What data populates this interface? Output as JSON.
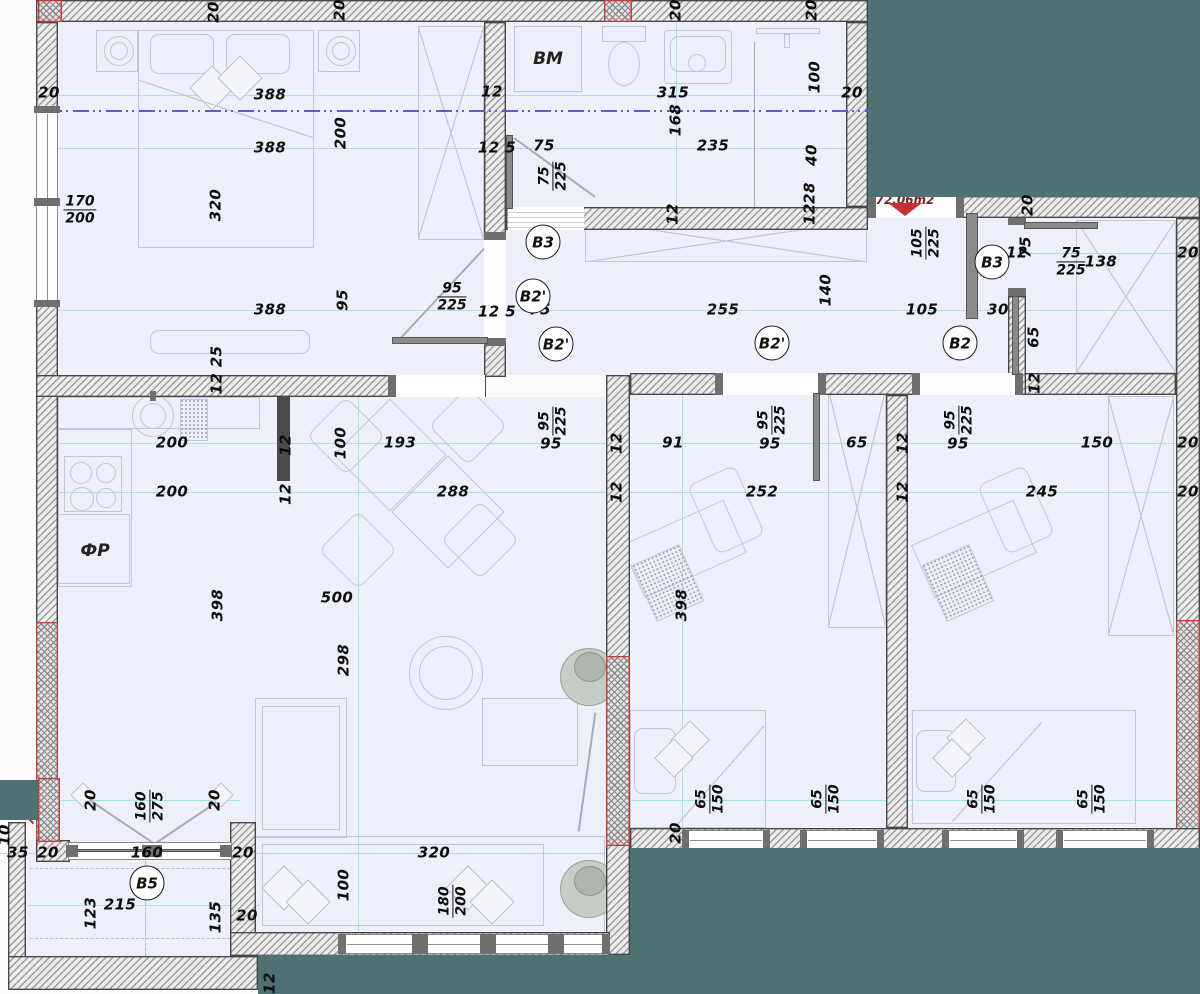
{
  "title": "Apartment floor plan 72.06m2",
  "colors": {
    "outside": "#4e7174",
    "room_fill": "#edeffa",
    "wall_hatch": "#9c9c9c",
    "accent_red": "#c53030",
    "dim_text": "#0d0d0d",
    "dim_line_cyan": "#a6e3e6",
    "axis_blue": "#5b5bd6"
  },
  "area": {
    "text": "72.06m2"
  },
  "room_labels": [
    {
      "text": "BM",
      "x": 548,
      "y": 59
    },
    {
      "text": "ФР",
      "x": 95,
      "y": 551
    }
  ],
  "circles": [
    {
      "label": "B3",
      "x": 543,
      "y": 242
    },
    {
      "label": "B2'",
      "x": 533,
      "y": 296
    },
    {
      "label": "B2'",
      "x": 556,
      "y": 344
    },
    {
      "label": "B2'",
      "x": 772,
      "y": 343
    },
    {
      "label": "B2",
      "x": 960,
      "y": 343
    },
    {
      "label": "B3",
      "x": 992,
      "y": 262
    },
    {
      "label": "B5",
      "x": 147,
      "y": 883
    }
  ],
  "dims": [
    {
      "t": "20",
      "x": 214,
      "y": 12,
      "r": 1
    },
    {
      "t": "20",
      "x": 340,
      "y": 10,
      "r": 1
    },
    {
      "t": "20",
      "x": 676,
      "y": 10,
      "r": 1
    },
    {
      "t": "20",
      "x": 812,
      "y": 10,
      "r": 1
    },
    {
      "t": "20",
      "x": 49,
      "y": 93
    },
    {
      "t": "388",
      "x": 270,
      "y": 95
    },
    {
      "t": "12",
      "x": 492,
      "y": 92
    },
    {
      "t": "315",
      "x": 673,
      "y": 93
    },
    {
      "t": "100",
      "x": 815,
      "y": 77,
      "r": 1
    },
    {
      "t": "20",
      "x": 852,
      "y": 93
    },
    {
      "t": "388",
      "x": 270,
      "y": 148
    },
    {
      "t": "200",
      "x": 341,
      "y": 133,
      "r": 1
    },
    {
      "t": "12 5",
      "x": 497,
      "y": 148
    },
    {
      "t": "75",
      "x": 544,
      "y": 146
    },
    {
      "t": "235",
      "x": 713,
      "y": 146
    },
    {
      "t": "168",
      "x": 676,
      "y": 120,
      "r": 1
    },
    {
      "t": "40",
      "x": 812,
      "y": 155,
      "r": 1
    },
    {
      "t": "28",
      "x": 810,
      "y": 193,
      "r": 1
    },
    {
      "t": "12",
      "x": 810,
      "y": 214,
      "r": 1
    },
    {
      "t": "320",
      "x": 216,
      "y": 205,
      "r": 1
    },
    {
      "t": "12",
      "x": 673,
      "y": 214,
      "r": 1
    },
    {
      "t": "20",
      "x": 1028,
      "y": 205,
      "r": 1
    },
    {
      "t": "12",
      "x": 1017,
      "y": 253
    },
    {
      "t": "75",
      "x": 1026,
      "y": 247,
      "r": 1
    },
    {
      "t": "138",
      "x": 1101,
      "y": 262
    },
    {
      "t": "20",
      "x": 1188,
      "y": 253
    },
    {
      "t": "388",
      "x": 270,
      "y": 310
    },
    {
      "t": "95",
      "x": 343,
      "y": 300,
      "r": 1
    },
    {
      "t": "12 5",
      "x": 497,
      "y": 312
    },
    {
      "t": "75",
      "x": 540,
      "y": 310
    },
    {
      "t": "140",
      "x": 826,
      "y": 290,
      "r": 1
    },
    {
      "t": "255",
      "x": 723,
      "y": 310
    },
    {
      "t": "105",
      "x": 922,
      "y": 310
    },
    {
      "t": "30",
      "x": 998,
      "y": 310
    },
    {
      "t": "65",
      "x": 1034,
      "y": 337,
      "r": 1
    },
    {
      "t": "12 25",
      "x": 217,
      "y": 370,
      "r": 1
    },
    {
      "t": "12",
      "x": 1035,
      "y": 383,
      "r": 1
    },
    {
      "t": "200",
      "x": 172,
      "y": 443
    },
    {
      "t": "12",
      "x": 286,
      "y": 445,
      "r": 1
    },
    {
      "t": "100",
      "x": 341,
      "y": 443,
      "r": 1
    },
    {
      "t": "193",
      "x": 400,
      "y": 443
    },
    {
      "t": "95",
      "x": 551,
      "y": 444
    },
    {
      "t": "12",
      "x": 617,
      "y": 443,
      "r": 1
    },
    {
      "t": "91",
      "x": 673,
      "y": 443
    },
    {
      "t": "95",
      "x": 770,
      "y": 444
    },
    {
      "t": "65",
      "x": 857,
      "y": 443
    },
    {
      "t": "12",
      "x": 903,
      "y": 443,
      "r": 1
    },
    {
      "t": "95",
      "x": 958,
      "y": 444
    },
    {
      "t": "150",
      "x": 1097,
      "y": 443
    },
    {
      "t": "20",
      "x": 1188,
      "y": 443
    },
    {
      "t": "200",
      "x": 172,
      "y": 492
    },
    {
      "t": "12",
      "x": 286,
      "y": 494,
      "r": 1
    },
    {
      "t": "288",
      "x": 453,
      "y": 492
    },
    {
      "t": "12",
      "x": 617,
      "y": 492,
      "r": 1
    },
    {
      "t": "252",
      "x": 762,
      "y": 492
    },
    {
      "t": "12",
      "x": 903,
      "y": 492,
      "r": 1
    },
    {
      "t": "245",
      "x": 1042,
      "y": 492
    },
    {
      "t": "20",
      "x": 1188,
      "y": 492
    },
    {
      "t": "398",
      "x": 218,
      "y": 605,
      "r": 1
    },
    {
      "t": "500",
      "x": 337,
      "y": 598
    },
    {
      "t": "398",
      "x": 682,
      "y": 605,
      "r": 1
    },
    {
      "t": "298",
      "x": 344,
      "y": 660,
      "r": 1
    },
    {
      "t": "20",
      "x": 91,
      "y": 800,
      "r": 1
    },
    {
      "t": "20",
      "x": 215,
      "y": 800,
      "r": 1
    },
    {
      "t": "20",
      "x": 676,
      "y": 833,
      "r": 1
    },
    {
      "t": "35",
      "x": 18,
      "y": 853
    },
    {
      "t": "20",
      "x": 48,
      "y": 853
    },
    {
      "t": "160",
      "x": 147,
      "y": 853
    },
    {
      "t": "20",
      "x": 243,
      "y": 853
    },
    {
      "t": "10",
      "x": 5,
      "y": 835,
      "r": 1
    },
    {
      "t": "320",
      "x": 434,
      "y": 853
    },
    {
      "t": "100",
      "x": 344,
      "y": 885,
      "r": 1
    },
    {
      "t": "123",
      "x": 91,
      "y": 913,
      "r": 1
    },
    {
      "t": "215",
      "x": 120,
      "y": 905
    },
    {
      "t": "135",
      "x": 216,
      "y": 917,
      "r": 1
    },
    {
      "t": "20",
      "x": 247,
      "y": 916
    },
    {
      "t": "12",
      "x": 270,
      "y": 983,
      "r": 1
    }
  ],
  "fracs": [
    {
      "a": "170",
      "b": "200",
      "x": 80,
      "y": 210
    },
    {
      "a": "95",
      "b": "225",
      "x": 452,
      "y": 297
    },
    {
      "a": "75",
      "b": "225",
      "x": 1071,
      "y": 262
    },
    {
      "a": "75",
      "b": "225",
      "x": 553,
      "y": 176,
      "r": 1
    },
    {
      "a": "105",
      "b": "225",
      "x": 926,
      "y": 243,
      "r": 1
    },
    {
      "a": "95",
      "b": "225",
      "x": 553,
      "y": 421,
      "r": 1
    },
    {
      "a": "95",
      "b": "225",
      "x": 772,
      "y": 420,
      "r": 1
    },
    {
      "a": "95",
      "b": "225",
      "x": 959,
      "y": 420,
      "r": 1
    },
    {
      "a": "160",
      "b": "275",
      "x": 150,
      "y": 806,
      "r": 1
    },
    {
      "a": "65",
      "b": "150",
      "x": 710,
      "y": 799,
      "r": 1
    },
    {
      "a": "65",
      "b": "150",
      "x": 826,
      "y": 799,
      "r": 1
    },
    {
      "a": "65",
      "b": "150",
      "x": 982,
      "y": 799,
      "r": 1
    },
    {
      "a": "65",
      "b": "150",
      "x": 1092,
      "y": 799,
      "r": 1
    },
    {
      "a": "180",
      "b": "200",
      "x": 453,
      "y": 901,
      "r": 1
    }
  ]
}
